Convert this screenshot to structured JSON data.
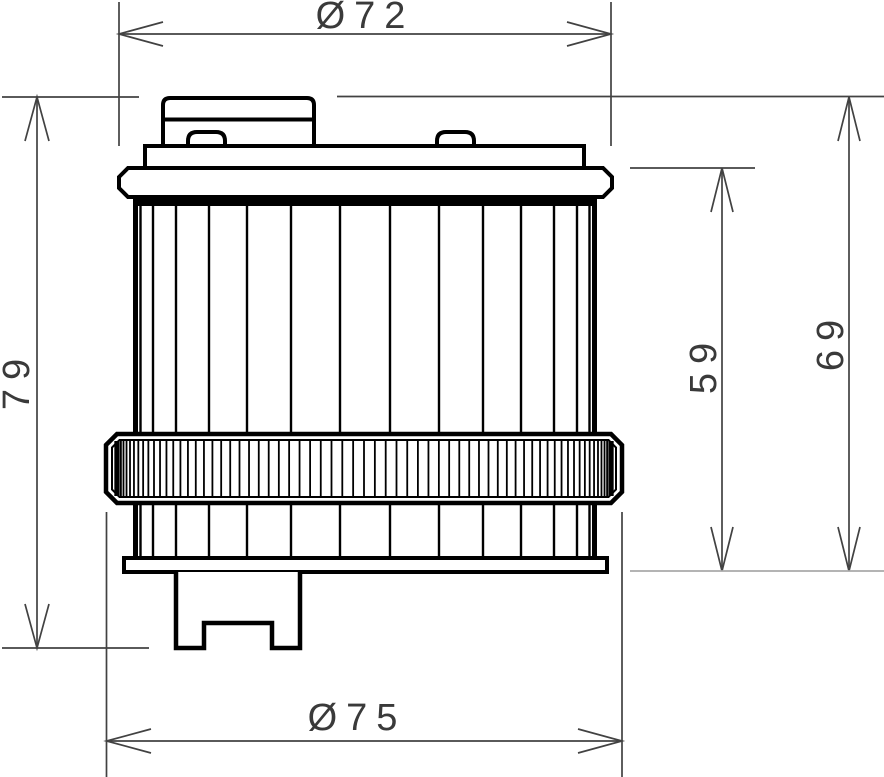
{
  "drawing": {
    "subject": "oil-filter-front-view-technical-drawing",
    "view": "front elevation with dimension lines"
  },
  "dimension_labels": {
    "top_diameter": "Ø72",
    "left_overall_height": "79",
    "right_inner_height": "59",
    "right_outer_height": "69",
    "bottom_diameter": "Ø75"
  },
  "colors": {
    "background": "#ffffff",
    "object_line": "#000000",
    "dimension_line": "#424242",
    "dimension_text": "#3a3a3a",
    "light_extension_line": "#a9a9a9"
  }
}
